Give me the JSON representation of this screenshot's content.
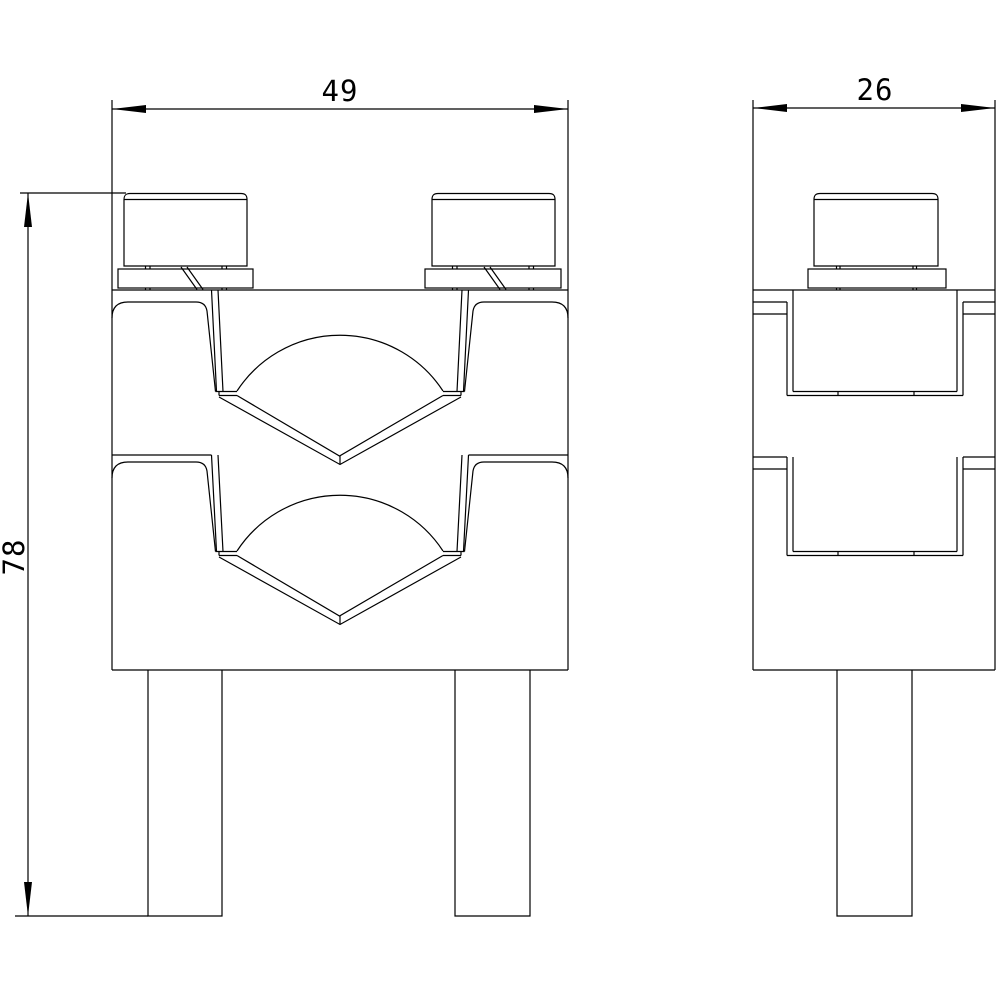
{
  "drawing": {
    "type": "engineering-dimension-drawing",
    "background_color": "#ffffff",
    "line_color": "#000000",
    "views": {
      "front": "front-view-with-two-v-clamp-pockets-two-screws-two-legs",
      "side": "side-view-with-one-screw-one-leg"
    },
    "dimensions": {
      "width": "49",
      "depth": "26",
      "height": "78"
    }
  }
}
